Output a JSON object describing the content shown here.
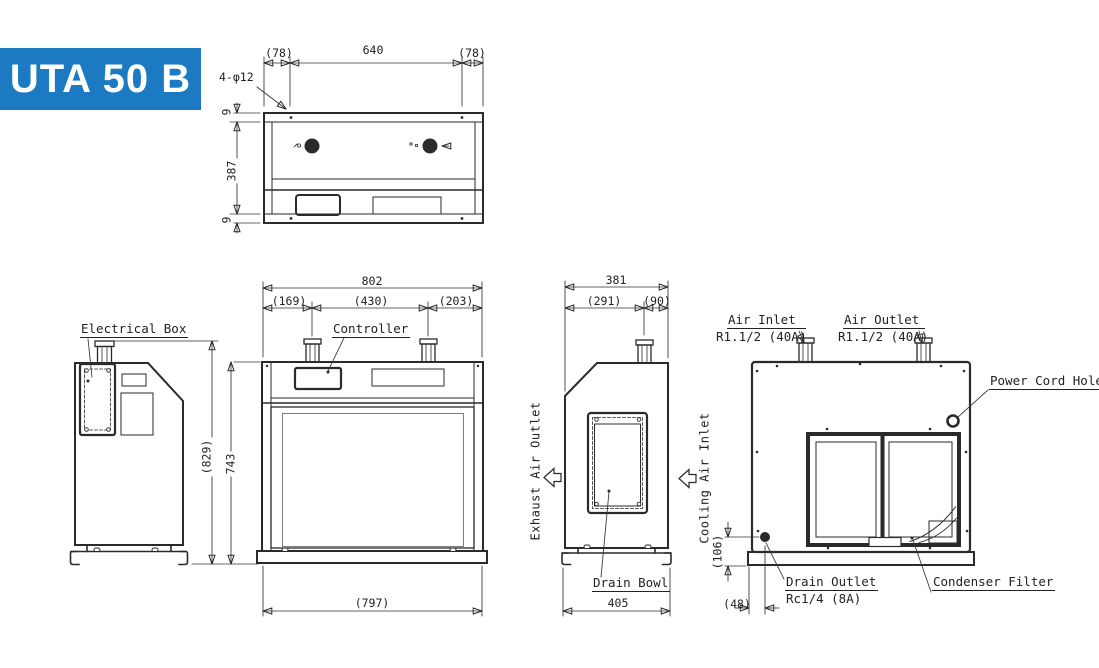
{
  "banner": {
    "model": "UTA 50 B",
    "bg_color": "#1b7ac1"
  },
  "top_view": {
    "dim_left_pad": "(78)",
    "dim_hole_span": "640",
    "dim_right_pad": "(78)",
    "dim_holes": "4-φ12",
    "dim_edge_front": "9",
    "dim_depth": "387",
    "dim_edge_rear": "9"
  },
  "front_view": {
    "dim_overall_width": "802",
    "dim_pipe_left": "(169)",
    "dim_pipe_span": "(430)",
    "dim_pipe_right": "(203)",
    "dim_overall_height": "(829)",
    "dim_body_height": "743",
    "dim_base_width": "(797)",
    "label_controller": "Controller"
  },
  "left_view": {
    "label_electrical_box": "Electrical Box"
  },
  "side_view": {
    "dim_overall_depth": "381",
    "dim_front": "(291)",
    "dim_rear": "(90)",
    "dim_base_depth": "405",
    "label_exhaust": "Exhaust Air Outlet",
    "label_cooling": "Cooling Air Inlet",
    "label_drain_bowl": "Drain Bowl"
  },
  "back_view": {
    "label_air_inlet": "Air Inlet",
    "spec_air_inlet": "R1.1/2 (40A)",
    "label_air_outlet": "Air Outlet",
    "spec_air_outlet": "R1.1/2 (40A)",
    "label_power_cord_hole": "Power Cord Hole",
    "label_drain_outlet": "Drain Outlet",
    "spec_drain_outlet": "Rc1/4 (8A)",
    "label_condenser_filter": "Condenser Filter",
    "dim_drain_height": "(106)",
    "dim_drain_offset": "(48)"
  }
}
